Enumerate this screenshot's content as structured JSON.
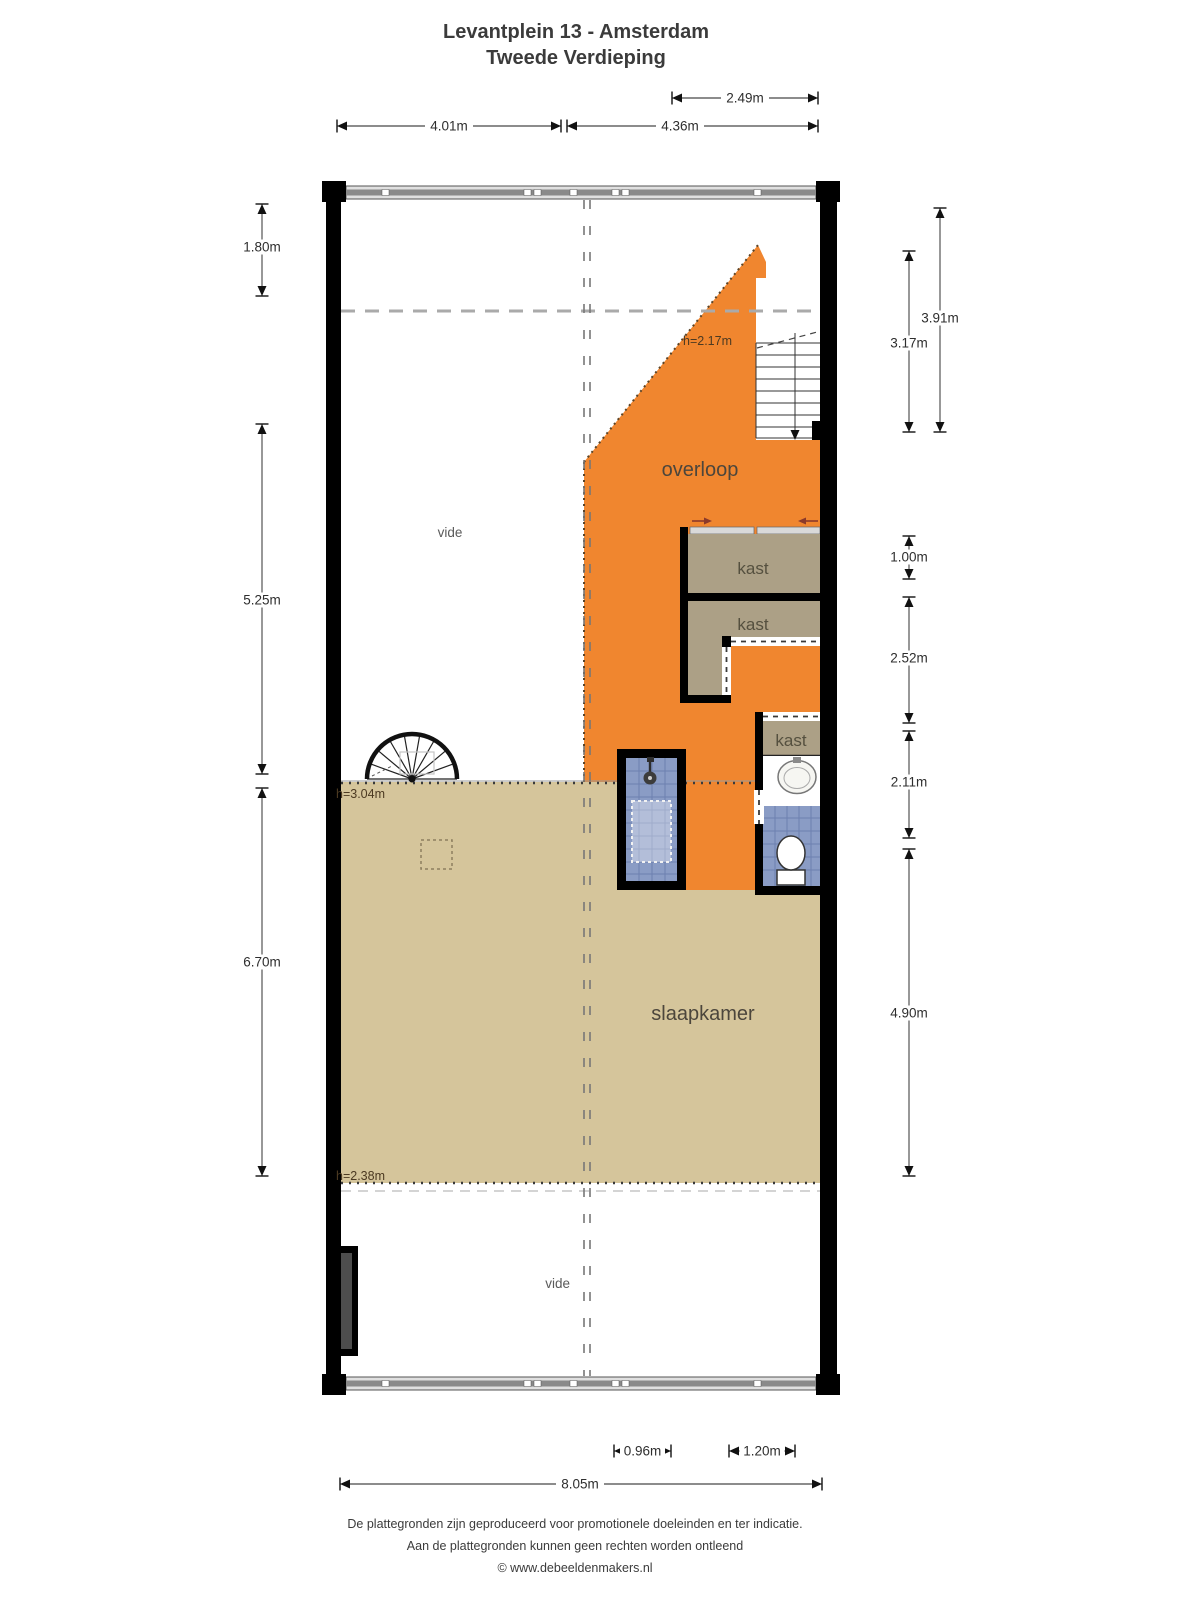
{
  "title": {
    "line1": "Levantplein 13 - Amsterdam",
    "line2": "Tweede Verdieping"
  },
  "rooms": {
    "overloop": "overloop",
    "slaapkamer": "slaapkamer",
    "kast_top": "kast",
    "kast_middle": "kast",
    "kast_small": "kast",
    "vide_top": "vide",
    "vide_bottom": "vide"
  },
  "heights": {
    "overloop_edge": "h=2.17m",
    "slaapkamer_front": "h=3.04m",
    "slaapkamer_back": "h=2.38m"
  },
  "dimensions": {
    "top_upper": "2.49m",
    "top_left": "4.01m",
    "top_right": "4.36m",
    "left_upper": "1.80m",
    "left_middle": "5.25m",
    "left_lower": "6.70m",
    "right_outer_upper": "3.91m",
    "right_inner_upper": "3.17m",
    "right_kast": "1.00m",
    "right_middle": "2.52m",
    "right_toilet": "2.11m",
    "right_lower": "4.90m",
    "bottom_shower": "0.96m",
    "bottom_toilet": "1.20m",
    "bottom_total": "8.05m"
  },
  "footer": {
    "line1": "De plattegronden zijn geproduceerd voor promotionele doeleinden en ter indicatie.",
    "line2": "Aan de plattegronden kunnen geen rechten worden ontleend",
    "line3": "© www.debeeldenmakers.nl"
  },
  "colors": {
    "overloop_fill": "#F0862F",
    "slaapkamer_fill": "#D5C59B",
    "kast_fill": "#ACA086",
    "tile_fill": "#8A9CC5",
    "wall": "#000000"
  }
}
